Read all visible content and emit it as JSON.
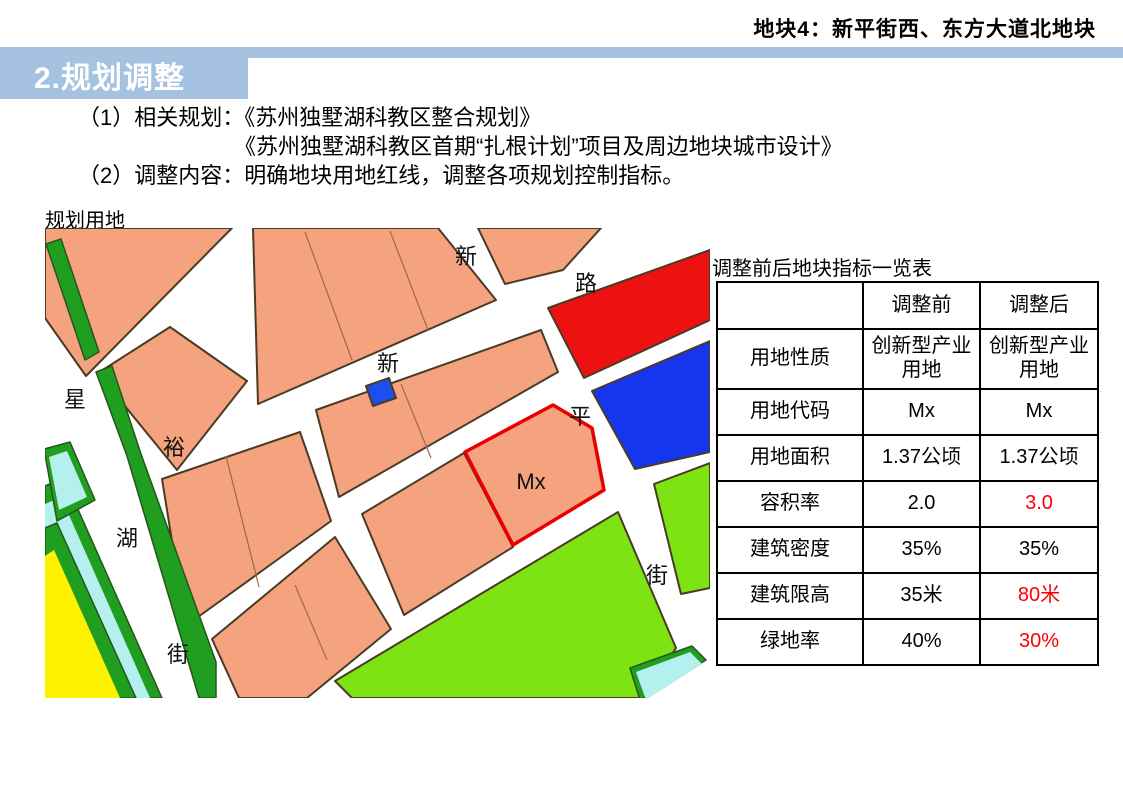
{
  "header": {
    "plot_title": "地块4：新平街西、东方大道北地块",
    "accent_color": "#a5c2e0"
  },
  "section": {
    "title": "2.规划调整"
  },
  "body": {
    "line1": "（1）相关规划：《苏州独墅湖科教区整合规划》",
    "line2": "《苏州独墅湖科教区首期“扎根计划”项目及周边地块城市设计》",
    "line3": "（2）调整内容：明确地块用地红线，调整各项规划控制指标。"
  },
  "map": {
    "label": "规划用地",
    "parcel_code": "Mx",
    "roads": {
      "xinghu": {
        "name": "星湖街",
        "chars": [
          "星",
          "湖",
          "街"
        ]
      },
      "yuxin": {
        "name": "裕新路",
        "chars": [
          "裕",
          "新",
          "路"
        ]
      },
      "xinping": {
        "name": "新平街",
        "chars": [
          "新",
          "平",
          "街"
        ]
      }
    },
    "colors": {
      "industrial_salmon": "#f5a27f",
      "green_buffer": "#1f9e1f",
      "park_green": "#7de312",
      "water_cyan": "#b4f0ee",
      "yellow_parcel": "#fff200",
      "red_parcel": "#ee1111",
      "blue_parcel": "#1535ee",
      "subject_outline_red": "#e80000"
    }
  },
  "table": {
    "title": "调整前后地块指标一览表",
    "col_headers": [
      "",
      "调整前",
      "调整后"
    ],
    "changed_color": "#ff0000",
    "rows": [
      {
        "label": "用地性质",
        "before": "创新型产业用地",
        "after": "创新型产业用地",
        "changed": false
      },
      {
        "label": "用地代码",
        "before": "Mx",
        "after": "Mx",
        "changed": false
      },
      {
        "label": "用地面积",
        "before": "1.37公顷",
        "after": "1.37公顷",
        "changed": false
      },
      {
        "label": "容积率",
        "before": "2.0",
        "after": "3.0",
        "changed": true
      },
      {
        "label": "建筑密度",
        "before": "35%",
        "after": "35%",
        "changed": false
      },
      {
        "label": "建筑限高",
        "before": "35米",
        "after": "80米",
        "changed": true
      },
      {
        "label": "绿地率",
        "before": "40%",
        "after": "30%",
        "changed": true
      }
    ]
  }
}
